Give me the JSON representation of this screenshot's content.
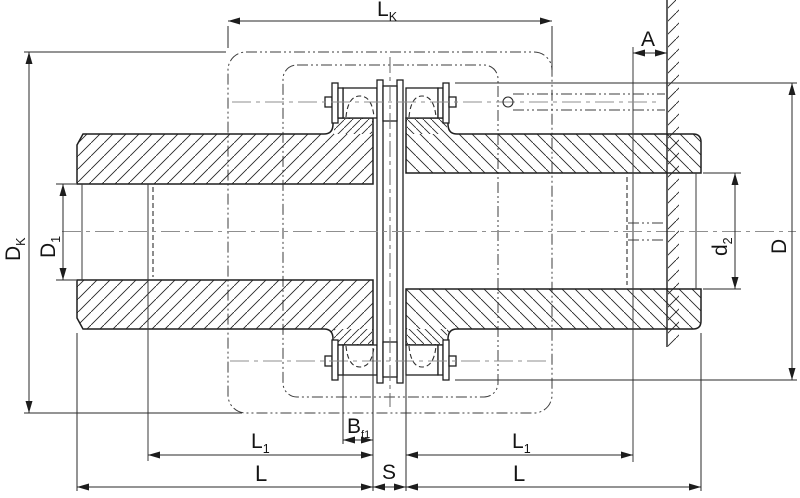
{
  "drawing": {
    "labels": {
      "lk": {
        "main": "L",
        "sub": "K"
      },
      "a": {
        "main": "A",
        "sub": ""
      },
      "dk": {
        "main": "D",
        "sub": "K"
      },
      "d1": {
        "main": "D",
        "sub": "1"
      },
      "d2": {
        "main": "d",
        "sub": "2"
      },
      "d": {
        "main": "D",
        "sub": ""
      },
      "l1_left": {
        "main": "L",
        "sub": "1"
      },
      "l1_right": {
        "main": "L",
        "sub": "1"
      },
      "bf1": {
        "main": "B",
        "sub": "f1"
      },
      "s": {
        "main": "S",
        "sub": ""
      },
      "l_left": {
        "main": "L",
        "sub": ""
      },
      "l_right": {
        "main": "L",
        "sub": ""
      }
    },
    "colors": {
      "outline": "#1f1f1f",
      "dimension": "#2a2a2a",
      "centerline": "#8f8f8f",
      "background": "#ffffff"
    }
  }
}
